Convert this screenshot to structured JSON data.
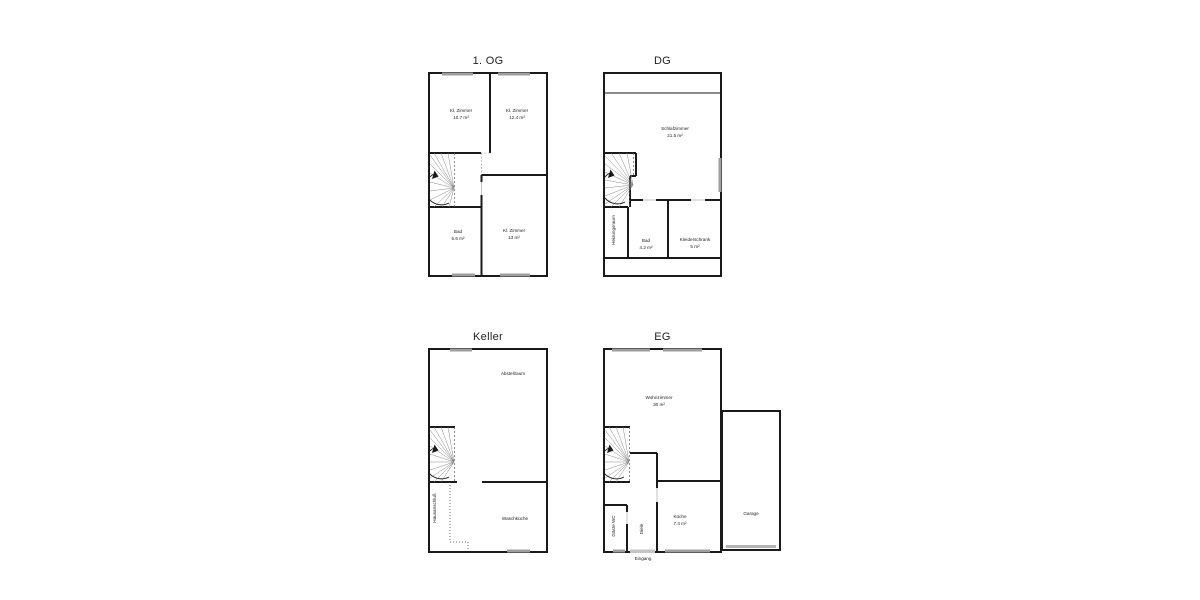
{
  "document": {
    "type": "floor-plan-sheet",
    "background": "#ffffff"
  },
  "colors": {
    "wall": "#1a1a1a",
    "window_bar": "#9e9e9e",
    "door_bar": "#c4c4c4",
    "stair_line": "#8a8a8a",
    "label": "#222222"
  },
  "floors": {
    "og1": {
      "title": "1. OG",
      "rooms": {
        "kl_zimmer_1": {
          "name": "Kl. Zimmer",
          "area": "10.7 m²"
        },
        "kl_zimmer_2": {
          "name": "Kl. Zimmer",
          "area": "12.4 m²"
        },
        "bad": {
          "name": "Bad",
          "area": "5.6 m²"
        },
        "kl_zimmer_3": {
          "name": "Kl. Zimmer",
          "area": "13 m²"
        }
      }
    },
    "dg": {
      "title": "DG",
      "rooms": {
        "schlafzimmer": {
          "name": "Schlafzimmer",
          "area": "21.5 m²"
        },
        "heizungsraum": {
          "name": "Heizungsraum"
        },
        "bad": {
          "name": "Bad",
          "area": "4.2 m²"
        },
        "kleiderschrank": {
          "name": "Kleiderschrank",
          "area": "5 m²"
        }
      }
    },
    "keller": {
      "title": "Keller",
      "rooms": {
        "abstellraum": {
          "name": "Abstellraum"
        },
        "waschkueche": {
          "name": "Waschküche"
        },
        "hausanschluss": {
          "name": "Hausanschluß"
        }
      }
    },
    "eg": {
      "title": "EG",
      "rooms": {
        "wohnzimmer": {
          "name": "Wohnzimmer",
          "area": "30 m²"
        },
        "kueche": {
          "name": "Küche",
          "area": "7.4 m²"
        },
        "garage": {
          "name": "Garage"
        },
        "gaeste_wc": {
          "name": "Gäste WC"
        },
        "diele": {
          "name": "Diele"
        },
        "eingang": {
          "name": "Eingang"
        }
      }
    }
  }
}
